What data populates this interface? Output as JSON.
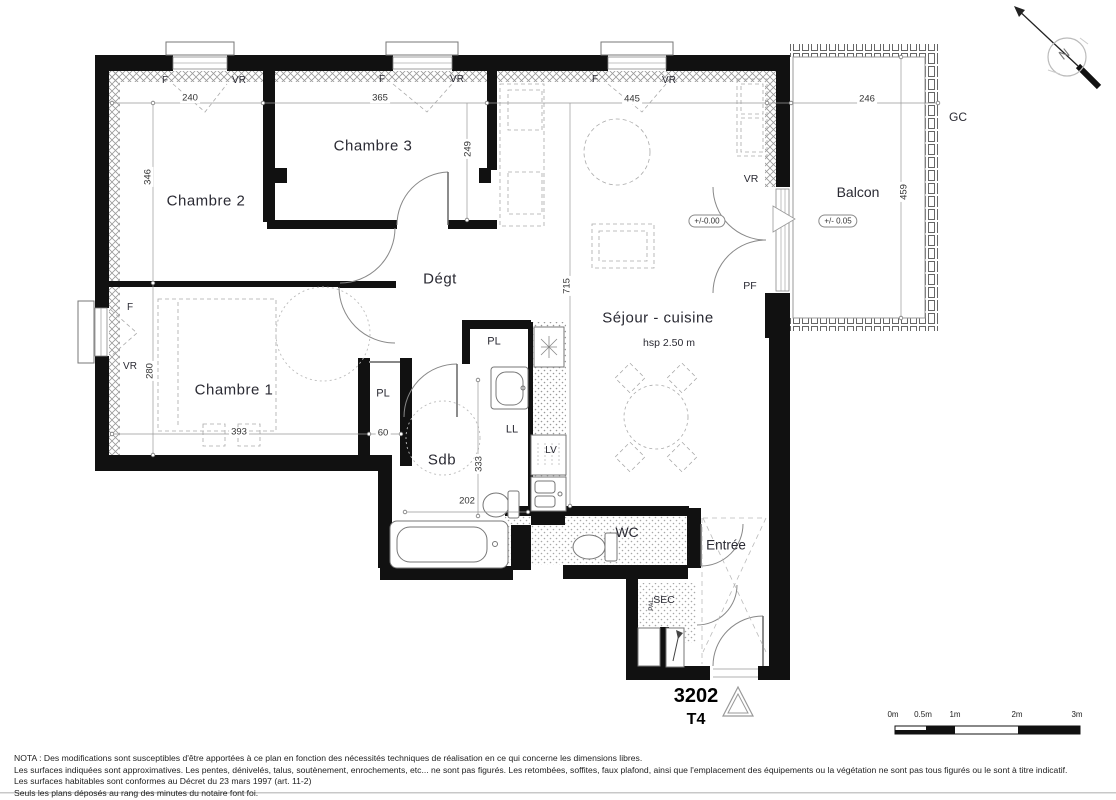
{
  "plan": {
    "number": "3202",
    "type": "T4"
  },
  "rooms": {
    "chambre1": "Chambre 1",
    "chambre2": "Chambre 2",
    "chambre3": "Chambre 3",
    "degagement": "Dégt",
    "sejour_cuisine": "Séjour - cuisine",
    "ceiling_height": "hsp 2.50 m",
    "balcon": "Balcon",
    "sdb": "Sdb",
    "wc": "WC",
    "entree": "Entrée",
    "sec": "SEC",
    "palier": "PAL.",
    "placard": "PL",
    "lave_linge": "LL",
    "lave_vaisselle": "LV",
    "gaine": "GC"
  },
  "openings": {
    "fenetre": "F",
    "volet_roulant": "VR",
    "porte_fenetre": "PF"
  },
  "levels": {
    "interieur": "+/-0.00",
    "balcon": "+/- 0.05"
  },
  "dimensions": {
    "d240": "240",
    "d365": "365",
    "d445": "445",
    "d246": "246",
    "d346": "346",
    "d249": "249",
    "d280": "280",
    "d393": "393",
    "d60": "60",
    "d202": "202",
    "d333": "333",
    "d715": "715",
    "d459": "459"
  },
  "compass": {
    "north": "N"
  },
  "scale_bar": {
    "labels": [
      "0m",
      "0.5m",
      "1m",
      "2m",
      "3m"
    ]
  },
  "notes": [
    "NOTA : Des modifications sont susceptibles d'être apportées à ce plan en fonction des nécessités techniques de réalisation en ce qui concerne les dimensions libres.",
    "Les surfaces indiquées sont approximatives. Les pentes, dénivelés, talus, soutènement, enrochements, etc... ne sont pas figurés. Les retombées, soffites, faux plafond, ainsi que l'emplacement des équipements ou la végétation ne sont pas tous figurés ou le sont à titre indicatif.",
    "Les surfaces habitables sont conformes au Décret du 23 mars 1997 (art. 11-2)",
    "Seuls les plans déposés au rang des minutes du notaire font foi."
  ]
}
